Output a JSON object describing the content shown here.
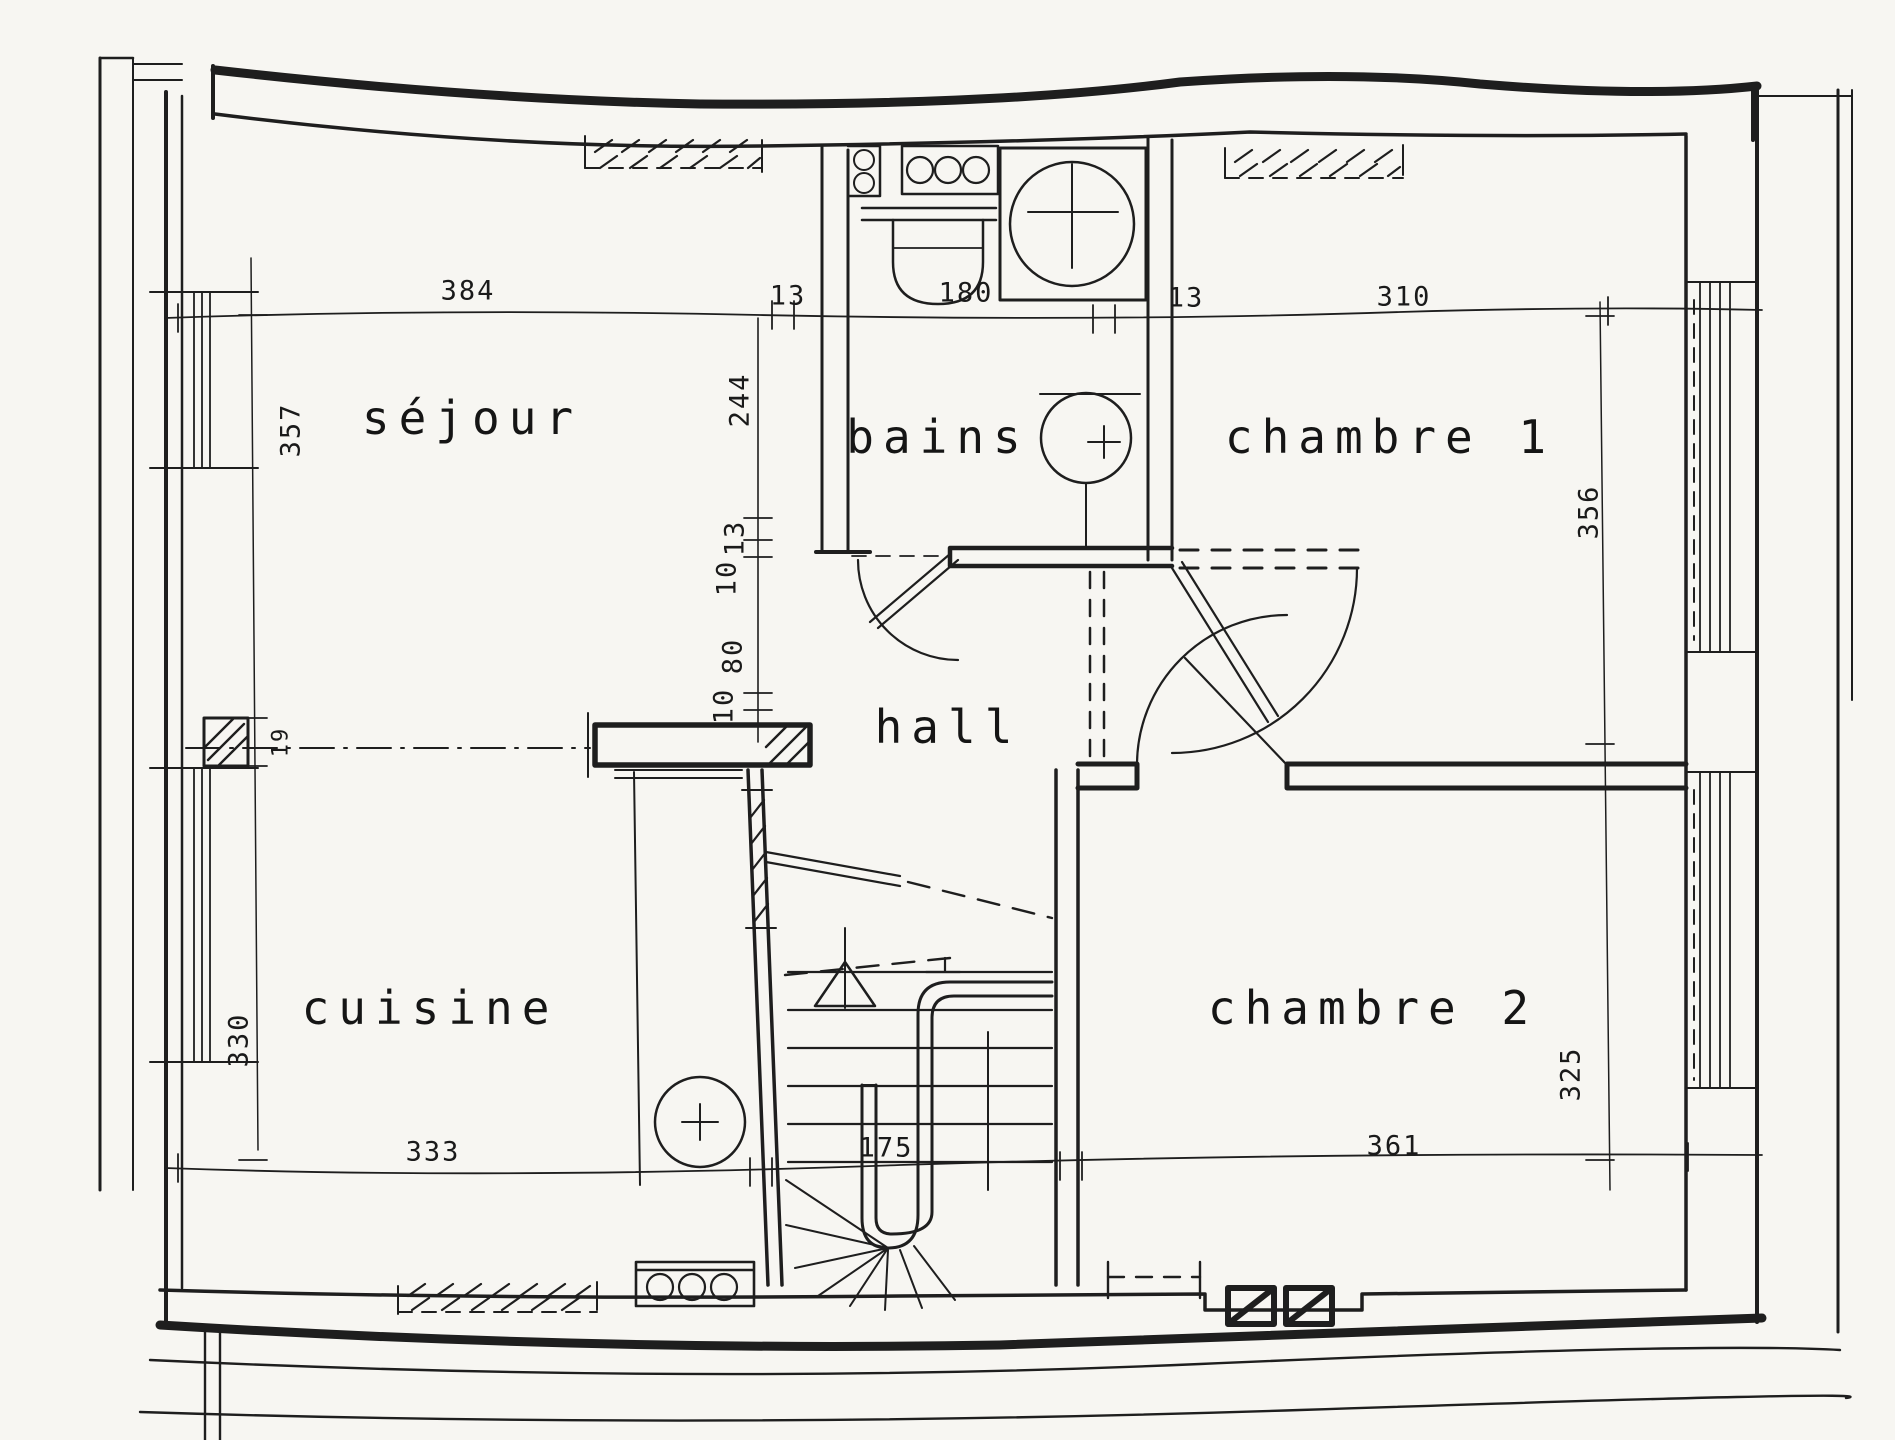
{
  "document_type": "scanned hand-drawn floor plan",
  "ink_color": "#1e1e1e",
  "paper_color": "#f7f6f2",
  "rooms": {
    "sejour": "séjour",
    "bains": "bains",
    "chambre1": "chambre 1",
    "hall": "hall",
    "cuisine": "cuisine",
    "chambre2": "chambre 2"
  },
  "dimensions": {
    "horizontal_top": [
      "384",
      "13",
      "180",
      "13",
      "310"
    ],
    "vertical_middle": [
      "244",
      "13",
      "10",
      "80",
      "10"
    ],
    "vertical_left": [
      "357",
      "19",
      "330"
    ],
    "vertical_right": [
      "356",
      "325"
    ],
    "horizontal_bottom": [
      "333",
      "175",
      "361"
    ]
  },
  "fixtures": [
    "toilet",
    "washbasin-counter",
    "soap-shelf",
    "bathtub",
    "washbasin",
    "kitchen-sink",
    "hob-burners",
    "winder-staircase",
    "stair-direction-arrow",
    "chimney-flues"
  ]
}
